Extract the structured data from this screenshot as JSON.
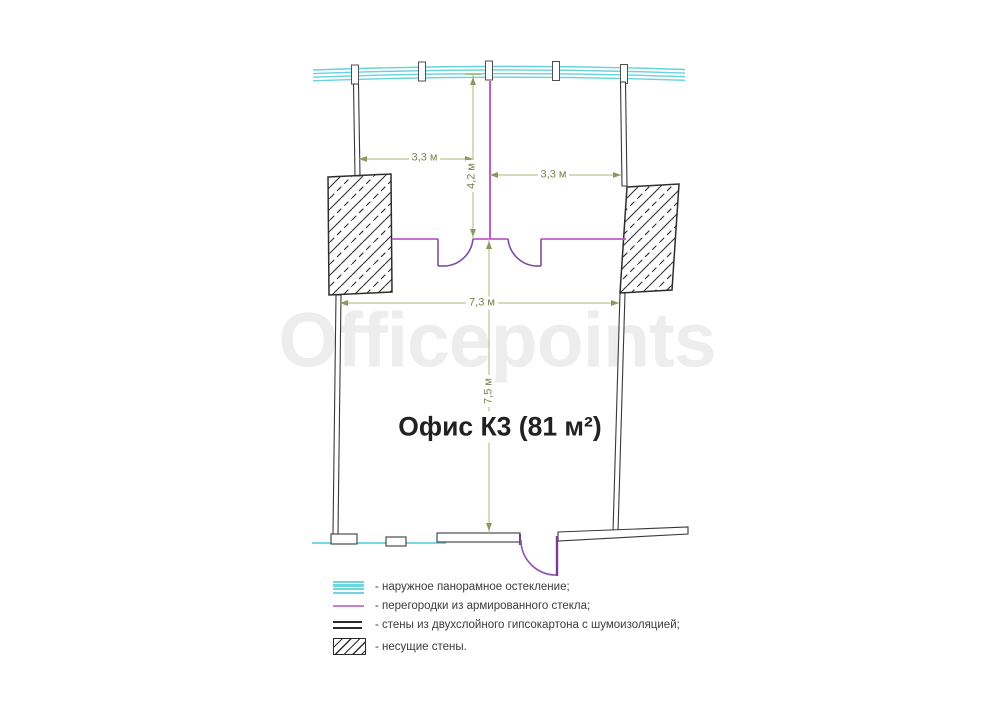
{
  "plan": {
    "title": "Офис К3 (81 м²)",
    "watermark": "Officepoints",
    "dimensions": {
      "left_room_width": "3,3 м",
      "right_room_width": "3,3 м",
      "rooms_depth": "4,2 м",
      "hall_width": "7,3 м",
      "hall_depth": "7,5 м"
    },
    "colors": {
      "glazing": "#66d2de",
      "glass_partition": "#c35bc7",
      "door_swing": "#7c4fa0",
      "entrance_door": "#7c3b92",
      "dimension_line": "#a8b87e",
      "dimension_text": "#76844c",
      "wall_outline": "#383838",
      "watermark": "#ededed"
    }
  },
  "legend": {
    "items": [
      {
        "id": "glazing",
        "label": "- наружное панорамное остекление;"
      },
      {
        "id": "glass-partition",
        "label": "- перегородки из армированного стекла;"
      },
      {
        "id": "drywall",
        "label": "- стены из двухслойного гипсокартона с шумоизоляцией;"
      },
      {
        "id": "bearing-wall",
        "label": "- несущие стены."
      }
    ]
  }
}
